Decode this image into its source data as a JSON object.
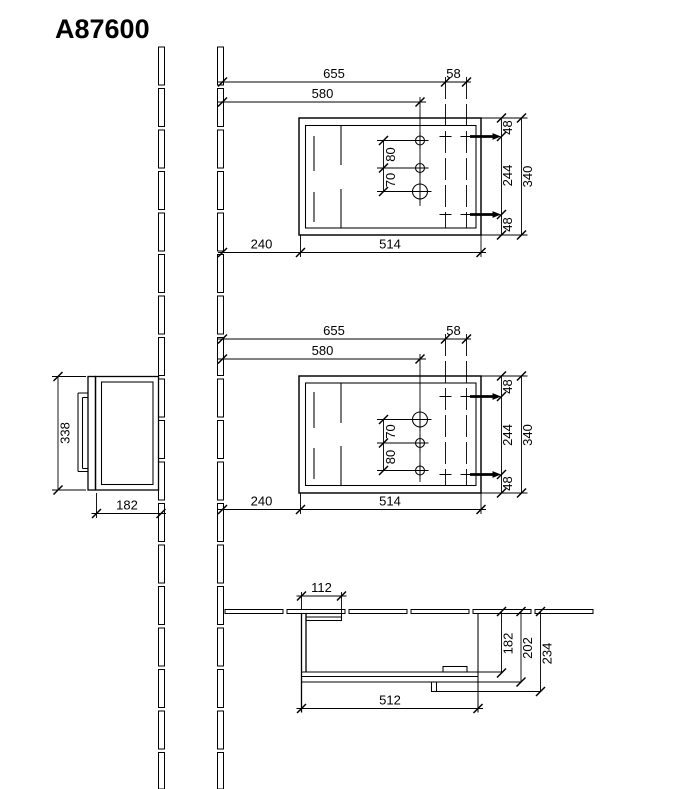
{
  "title": "A87600",
  "view_top": {
    "overall_width": "655",
    "center_width": "580",
    "hinge_span": "58",
    "wall_gap": "240",
    "carcass_width": "514",
    "hole_gap_upper": "80",
    "hole_gap_lower": "70",
    "hinge_top": "48",
    "hinge_spacing": "244",
    "hinge_bottom": "48",
    "height": "340"
  },
  "view_mid": {
    "overall_width": "655",
    "center_width": "580",
    "hinge_span": "58",
    "wall_gap": "240",
    "carcass_width": "514",
    "hole_gap_upper": "70",
    "hole_gap_lower": "80",
    "hinge_top": "48",
    "hinge_spacing": "244",
    "hinge_bottom": "48",
    "height": "340"
  },
  "view_side": {
    "height": "338",
    "depth": "182"
  },
  "view_plan": {
    "side_panel": "112",
    "width": "512",
    "depth_inner": "182",
    "depth_door": "202",
    "depth_handle": "234"
  }
}
